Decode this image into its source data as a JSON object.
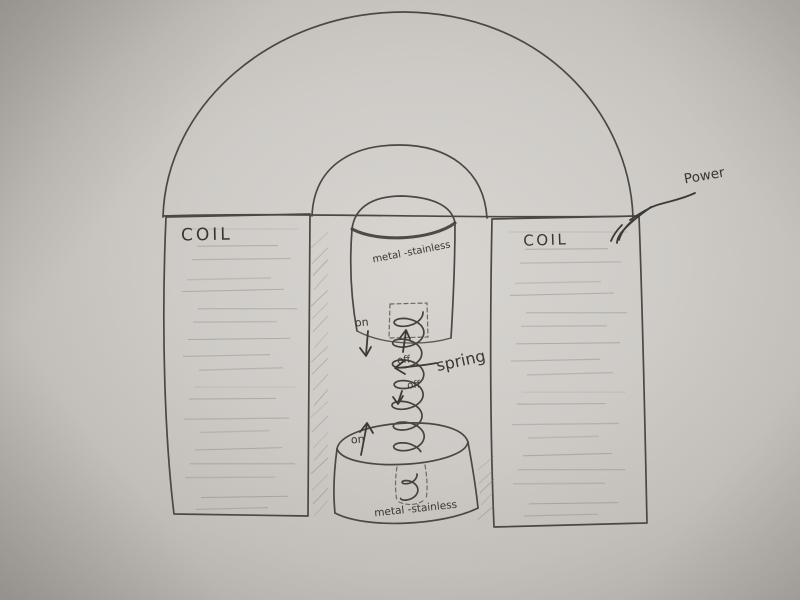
{
  "photo": {
    "description": "Hand-drawn pencil diagram of an electromagnet coil actuator on paper",
    "paper_color": "#cfccc8",
    "pencil_color": "#4c4741"
  },
  "labels": {
    "coil_left": "COIL",
    "coil_right": "COIL",
    "top_metal": "metal -stainless",
    "bottom_metal": "metal -stainless",
    "spring": "spring",
    "power": "Power",
    "on_upper": "on",
    "off_upper": "off",
    "off_lower": "off",
    "on_lower": "on"
  }
}
